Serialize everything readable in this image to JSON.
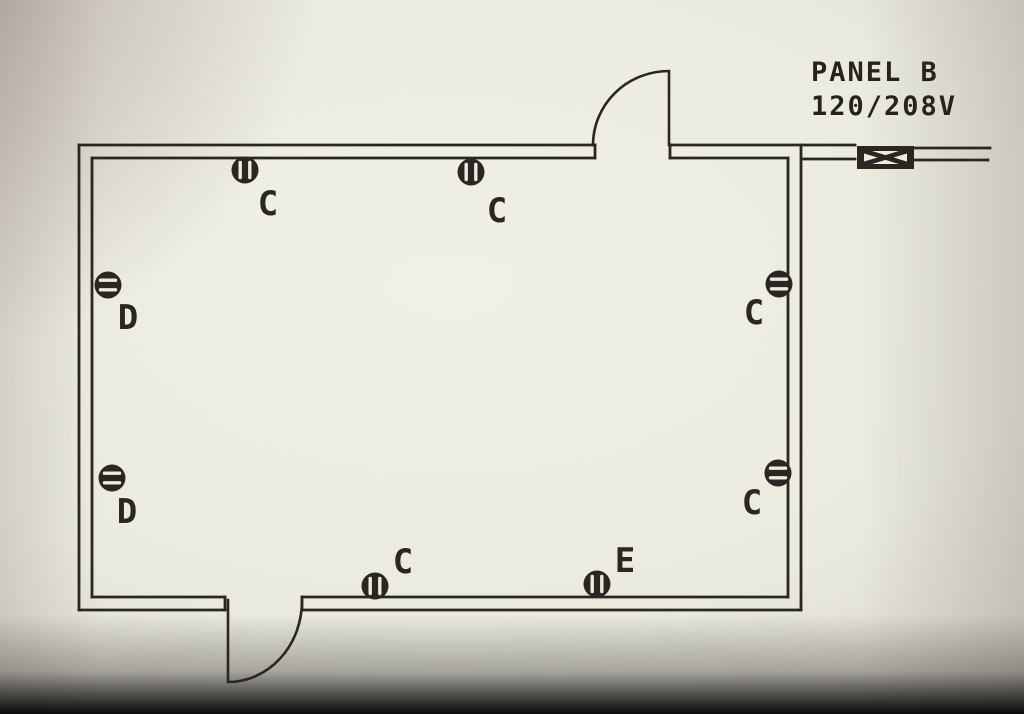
{
  "drawing": {
    "type": "electrical floor plan",
    "panel": {
      "name": "PANEL B",
      "voltage": "120/208V"
    },
    "outlets": [
      {
        "id": "top-wall-1",
        "wall": "top",
        "circuit": "C"
      },
      {
        "id": "top-wall-2",
        "wall": "top",
        "circuit": "C"
      },
      {
        "id": "left-wall-1",
        "wall": "left",
        "circuit": "D"
      },
      {
        "id": "left-wall-2",
        "wall": "left",
        "circuit": "D"
      },
      {
        "id": "right-wall-1",
        "wall": "right",
        "circuit": "C"
      },
      {
        "id": "right-wall-2",
        "wall": "right",
        "circuit": "C"
      },
      {
        "id": "bottom-wall-1",
        "wall": "bottom",
        "circuit": "C"
      },
      {
        "id": "bottom-wall-2",
        "wall": "bottom",
        "circuit": "E"
      }
    ],
    "colors": {
      "ink": "#2a2722",
      "paper": "#edece2"
    }
  }
}
